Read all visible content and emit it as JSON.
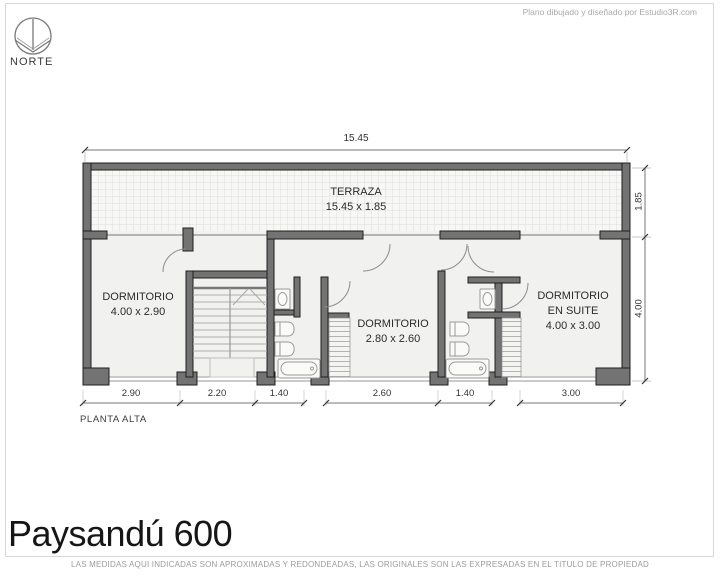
{
  "page": {
    "credit": "Plano dibujado y diseñado por Estudio3R.com",
    "title": "Paysandú 600",
    "footer_disclaimer": "LAS MEDIDAS AQUI INDICADAS SON APROXIMADAS Y REDONDEADAS, LAS ORIGINALES SON LAS EXPRESADAS EN EL TITULO DE PROPIEDAD",
    "plan_label": "PLANTA ALTA"
  },
  "compass": {
    "label": "NORTE"
  },
  "rooms": {
    "terraza": {
      "name": "TERRAZA",
      "dims": "15.45 x 1.85"
    },
    "dormitorio1": {
      "name": "DORMITORIO",
      "dims": "4.00 x 2.90"
    },
    "dormitorio2": {
      "name": "DORMITORIO",
      "dims": "2.80 x 2.60"
    },
    "suite": {
      "name": "DORMITORIO",
      "name2": "EN SUITE",
      "dims": "4.00 x 3.00"
    }
  },
  "dimensions": {
    "top_total": "15.45",
    "right": [
      "1.85",
      "4.00"
    ],
    "bottom": [
      "2.90",
      "2.20",
      "1.40",
      "2.60",
      "1.40",
      "3.00"
    ]
  },
  "colors": {
    "wall": "#737373",
    "floor": "#f1f1ef",
    "terrace_grid": "#dcdcda",
    "dimension_text": "#333333",
    "muted_text": "#9b9b9b"
  }
}
